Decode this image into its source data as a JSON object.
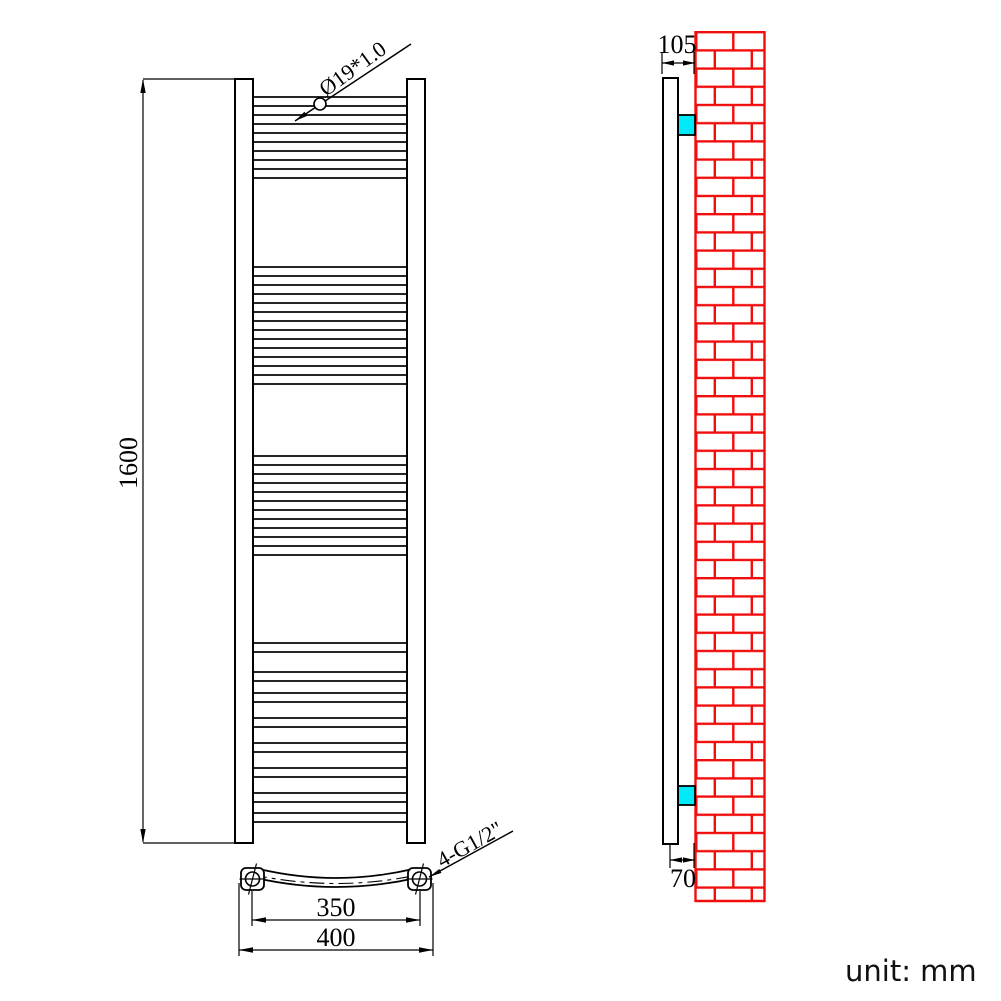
{
  "unit_note": "unit: mm",
  "colors": {
    "line": "#000000",
    "brick": "#f20d0d",
    "bracket": "#00e9f6",
    "background": "#ffffff"
  },
  "front_view": {
    "height_dim_label": "1600",
    "tube_spec_label": "Ø19*1.0",
    "connection_spec_label": "4-G1/2\"",
    "center_distance_label": "350",
    "overall_width_label": "400",
    "rung_x": 252,
    "rung_width": 156,
    "rung_height": 9,
    "rung_groups": [
      {
        "tops": [
          97,
          115,
          133,
          151,
          169
        ]
      },
      {
        "tops": [
          267,
          285,
          303,
          321,
          339,
          357,
          375
        ]
      },
      {
        "tops": [
          456,
          474,
          492,
          510,
          528,
          546
        ]
      },
      {
        "tops": [
          643,
          672,
          693,
          718,
          743,
          768,
          793,
          813
        ]
      }
    ]
  },
  "side_view": {
    "top_dim_label": "105",
    "bottom_dim_label": "70"
  }
}
